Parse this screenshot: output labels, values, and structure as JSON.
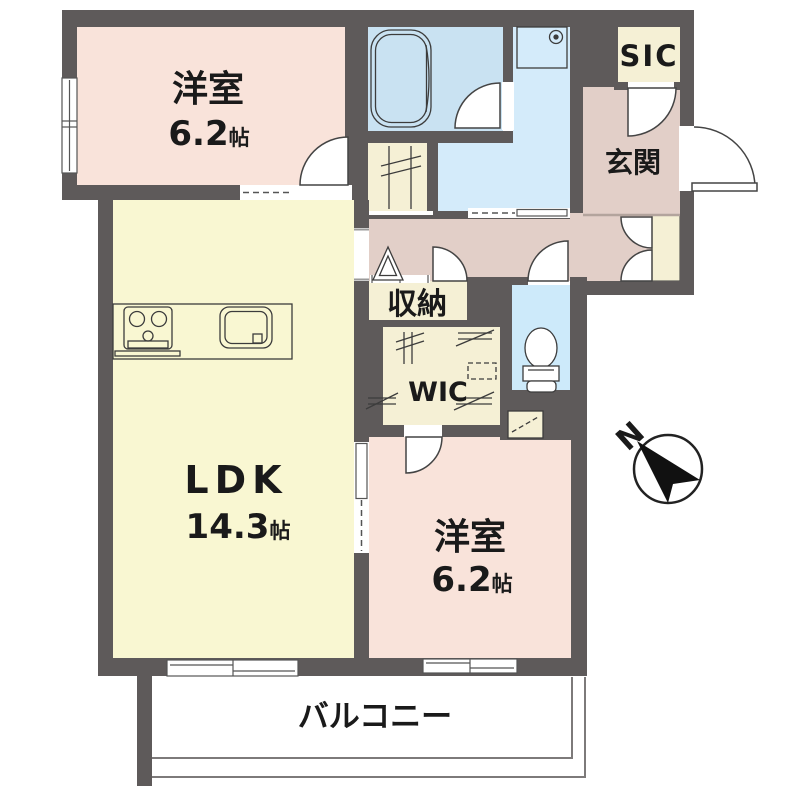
{
  "plan": {
    "type": "japanese-apartment-floor-plan",
    "rooms": {
      "bedroom_top": {
        "name": "洋室",
        "size_value": "6.2",
        "size_unit": "帖"
      },
      "ldk": {
        "name": "LDK",
        "size_value": "14.3",
        "size_unit": "帖"
      },
      "bedroom_bottom": {
        "name": "洋室",
        "size_value": "6.2",
        "size_unit": "帖"
      },
      "entrance": {
        "name": "玄関"
      },
      "storage": {
        "name": "収納"
      },
      "walk_in_closet": {
        "name": "WIC"
      },
      "shoes_in_closet": {
        "name": "SIC"
      },
      "balcony": {
        "name": "バルコニー"
      }
    },
    "compass": {
      "north_label": "N"
    },
    "colors": {
      "wall": "#5e5a5a",
      "bedroom_fill": "#f9e3da",
      "ldk_fill": "#f9f7d2",
      "hall_fill": "#e2cfc8",
      "closet_fill": "#f5f0d5",
      "bathroom_fill": "#c9e2f2",
      "washroom_fill": "#d4ebfa",
      "toilet_fill": "#cdeafa",
      "line": "#3c3c3c",
      "text": "#1a1a1a"
    }
  }
}
